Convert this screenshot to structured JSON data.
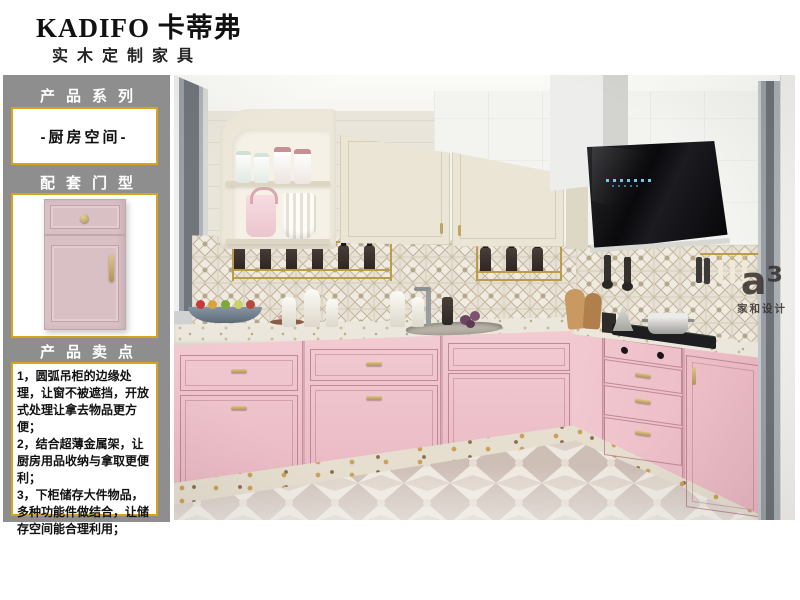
{
  "brand": {
    "title": "KADIFO 卡蒂弗",
    "subtitle": "实木定制家具"
  },
  "sidebar": {
    "series_label": "产品系列",
    "series_value": "-厨房空间-",
    "door_label": "配套门型",
    "points_label": "产品卖点",
    "selling_points": [
      "1，圆弧吊柜的边缘处理，让窗不被遮挡，开放式处理让拿去物品更方便；",
      "2，结合超薄金属架，让厨房用品收纳与拿取更便利；",
      "3，下柜储存大件物品，多种功能件做结合，让储存空间能合理利用；"
    ]
  },
  "photo": {
    "watermark": {
      "logo": "a³",
      "caption": "家和设计"
    }
  },
  "colors": {
    "accent_gold_border": "#d6a41f",
    "sidebar_gray": "#8e8e8e",
    "cabinet_pink": "#efc3cb",
    "cabinet_cream": "#eae5d5",
    "hood_black": "#0c0c0e",
    "led_blue": "#6fd2f5",
    "hardware_gold": "#b3945a"
  }
}
